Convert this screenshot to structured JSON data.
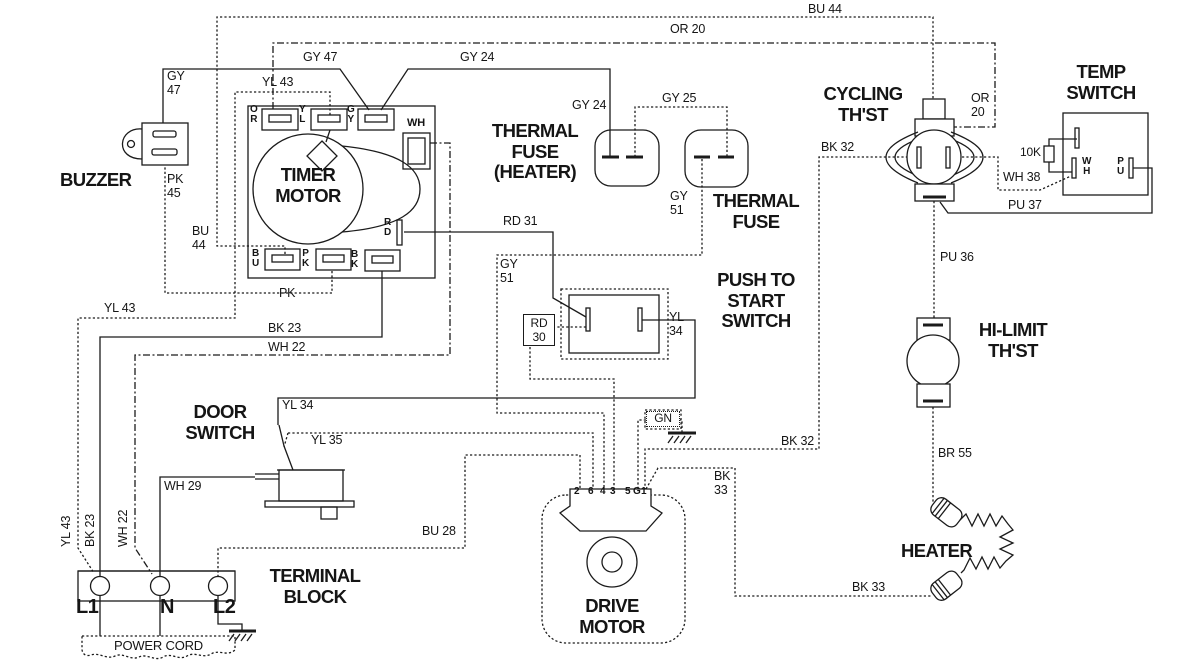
{
  "diagram": {
    "colors": {
      "line": "#1b1b1b",
      "background": "#ffffff"
    },
    "components": {
      "buzzer": "BUZZER",
      "timer_motor": "TIMER\nMOTOR",
      "thermal_fuse_heater": "THERMAL\nFUSE\n(HEATER)",
      "thermal_fuse": "THERMAL\nFUSE",
      "cycling_thst": "CYCLING\nTH'ST",
      "temp_switch": "TEMP\nSWITCH",
      "push_to_start": "PUSH TO\nSTART\nSWITCH",
      "door_switch": "DOOR\nSWITCH",
      "terminal_block": "TERMINAL\nBLOCK",
      "power_cord": "POWER CORD",
      "drive_motor": "DRIVE\nMOTOR",
      "hi_limit": "HI-LIMIT\nTH'ST",
      "heater": "HEATER",
      "ground": "GN",
      "resistor_10k": "10K"
    },
    "terminals": {
      "timer_or": "O\nR",
      "timer_yl": "Y\nL",
      "timer_gy": "G\nY",
      "timer_wh": "WH",
      "timer_rd": "R\nD",
      "timer_bu": "B\nU",
      "timer_pk": "P\nK",
      "timer_bk": "B\nK",
      "temp_wh": "W\nH",
      "temp_pu": "P\nU",
      "block_l1": "L1",
      "block_n": "N",
      "block_l2": "L2"
    },
    "motor_pins": [
      "2",
      "6",
      "4",
      "3",
      "5",
      "G",
      "1"
    ],
    "wire_labels": {
      "bu44_top": "BU 44",
      "or20_top": "OR 20",
      "gy47_top": "GY 47",
      "gy24_top": "GY 24",
      "yl43_top": "YL 43",
      "gy47_side": "GY\n47",
      "pk45": "PK\n45",
      "bu44_side": "BU\n44",
      "gy24_mid": "GY 24",
      "gy25": "GY 25",
      "gy51_fuse": "GY\n51",
      "rd31": "RD 31",
      "pk": "PK",
      "yl43_mid": "YL 43",
      "bk23_mid": "BK 23",
      "wh22_mid": "WH 22",
      "gy51_switch": "GY\n51",
      "rd30": "RD\n30",
      "yl34_switch": "YL\n34",
      "or20_side": "OR\n20",
      "bk32_top": "BK 32",
      "wh38": "WH 38",
      "pu37": "PU 37",
      "pu36": "PU 36",
      "br55": "BR 55",
      "bk32_bottom": "BK 32",
      "bk33_motor": "BK\n33",
      "bk33_heater": "BK 33",
      "yl34_door": "YL 34",
      "yl35": "YL 35",
      "wh29": "WH 29",
      "bu28": "BU 28",
      "yl43_vert": "YL 43",
      "bk23_vert": "BK 23",
      "wh22_vert": "WH 22"
    }
  }
}
